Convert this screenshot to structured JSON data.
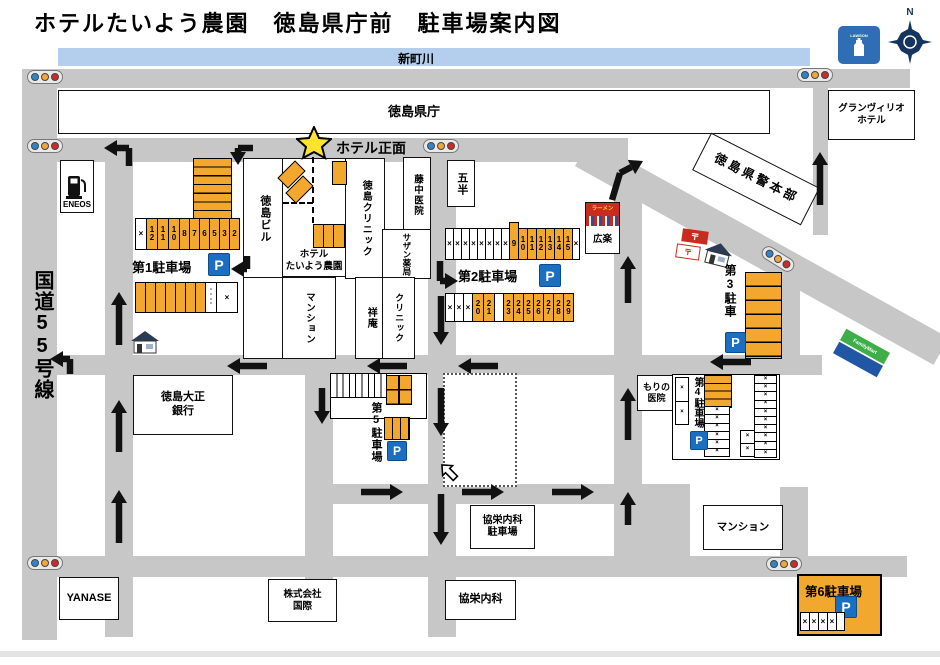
{
  "title": "ホテルたいよう農園　徳島県庁前　駐車場案内図",
  "labels": {
    "river": "新町川",
    "route55": "国道55号線",
    "hotel_front": "ホテル正面",
    "north": "N",
    "p_mark": "P",
    "x_mark": "×",
    "lawson": "LAWSON",
    "familymart": "FamilyMart",
    "post_mark": "〒"
  },
  "buildings": {
    "kencho": {
      "label": "徳島県庁"
    },
    "grandvrio": {
      "line1": "グランヴィリオ",
      "line2": "ホテル"
    },
    "eneos": {
      "label": "ENEOS"
    },
    "tokushima_bldg": {
      "label": "徳島ビル"
    },
    "hotel": {
      "line1": "ホテル",
      "line2": "たいよう農園"
    },
    "tokushima_clinic": {
      "label": "徳島クリニック"
    },
    "fujinaka": {
      "label": "藤中医院"
    },
    "southern_pharmacy": {
      "label": "サザン薬局"
    },
    "gohan": {
      "label": "五半"
    },
    "mansion_mid": {
      "label": "マンション"
    },
    "shoan": {
      "label": "祥庵"
    },
    "clinic": {
      "label": "クリニック"
    },
    "ramen": {
      "sign": "ラーメン",
      "label": "広楽"
    },
    "police": {
      "label": "徳島県警本部"
    },
    "taisho_bank": {
      "line1": "徳島大正",
      "line2": "銀行"
    },
    "mori_clinic": {
      "line1": "もりの",
      "line2": "医院"
    },
    "kyoei_parking": {
      "line1": "協栄内科",
      "line2": "駐車場"
    },
    "kyoei": {
      "label": "協栄内科"
    },
    "kokusai": {
      "line1": "株式会社",
      "line2": "国際"
    },
    "yanase": {
      "label": "YANASE"
    },
    "mansion_bottom": {
      "label": "マンション"
    }
  },
  "parkings": {
    "p1": {
      "name": "第1駐車場",
      "row_main": [
        {
          "t": "×",
          "c": "w",
          "w": 10
        },
        {
          "t": "12",
          "c": "y",
          "w": 10
        },
        {
          "t": "11",
          "c": "y",
          "w": 10
        },
        {
          "t": "10",
          "c": "y",
          "w": 10
        },
        {
          "t": "8",
          "c": "y",
          "w": 9
        },
        {
          "t": "7",
          "c": "y",
          "w": 9
        },
        {
          "t": "6",
          "c": "y",
          "w": 9
        },
        {
          "t": "5",
          "c": "y",
          "w": 9
        },
        {
          "t": "3",
          "c": "y",
          "w": 9
        },
        {
          "t": "2",
          "c": "y",
          "w": 9
        }
      ],
      "row_bottom": [
        {
          "t": "",
          "c": "y",
          "w": 9
        },
        {
          "t": "",
          "c": "y",
          "w": 9
        },
        {
          "t": "",
          "c": "y",
          "w": 9
        },
        {
          "t": "",
          "c": "y",
          "w": 9
        },
        {
          "t": "",
          "c": "y",
          "w": 9
        },
        {
          "t": "",
          "c": "y",
          "w": 9
        },
        {
          "t": "",
          "c": "y",
          "w": 9
        },
        {
          "t": "・・・・",
          "c": "w",
          "w": 10,
          "m": 1
        },
        {
          "t": "×",
          "c": "w",
          "w": 20
        }
      ]
    },
    "p2": {
      "name": "第2駐車場",
      "row_top": [
        {
          "t": "×",
          "c": "w",
          "w": 7
        },
        {
          "t": "×",
          "c": "w",
          "w": 7
        },
        {
          "t": "×",
          "c": "w",
          "w": 7
        },
        {
          "t": "×",
          "c": "w",
          "w": 7
        },
        {
          "t": "×",
          "c": "w",
          "w": 7
        },
        {
          "t": "×",
          "c": "w",
          "w": 7
        },
        {
          "t": "×",
          "c": "w",
          "w": 7
        },
        {
          "t": "×",
          "c": "w",
          "w": 7
        },
        {
          "t": "9",
          "c": "y",
          "w": 8,
          "tab": 1
        },
        {
          "t": "10",
          "c": "y",
          "w": 8
        },
        {
          "t": "11",
          "c": "y",
          "w": 8
        },
        {
          "t": "12",
          "c": "y",
          "w": 8
        },
        {
          "t": "13",
          "c": "y",
          "w": 8
        },
        {
          "t": "14",
          "c": "y",
          "w": 8
        },
        {
          "t": "15",
          "c": "y",
          "w": 8
        },
        {
          "t": "×",
          "c": "w",
          "w": 6
        }
      ],
      "row_bottom": [
        {
          "t": "×",
          "c": "w",
          "w": 8
        },
        {
          "t": "×",
          "c": "w",
          "w": 8
        },
        {
          "t": "×",
          "c": "w",
          "w": 8
        },
        {
          "t": "20",
          "c": "y",
          "w": 10
        },
        {
          "t": "21",
          "c": "y",
          "w": 10
        },
        {
          "t": "",
          "c": "w",
          "w": 8
        },
        {
          "t": "23",
          "c": "y",
          "w": 9
        },
        {
          "t": "24",
          "c": "y",
          "w": 9
        },
        {
          "t": "25",
          "c": "y",
          "w": 9
        },
        {
          "t": "26",
          "c": "y",
          "w": 9
        },
        {
          "t": "27",
          "c": "y",
          "w": 9
        },
        {
          "t": "28",
          "c": "y",
          "w": 9
        },
        {
          "t": "29",
          "c": "y",
          "w": 9
        }
      ]
    },
    "p3": {
      "name": "第3駐車"
    },
    "p4": {
      "name": "第4駐車場"
    },
    "p5": {
      "name": "第5駐車場"
    },
    "p6": {
      "name": "第6駐車場",
      "stalls": [
        {
          "t": "×",
          "c": "w",
          "w": 8
        },
        {
          "t": "×",
          "c": "w",
          "w": 8
        },
        {
          "t": "×",
          "c": "w",
          "w": 8
        },
        {
          "t": "×",
          "c": "w",
          "w": 8
        },
        {
          "t": "",
          "c": "w",
          "w": 7
        }
      ]
    }
  },
  "map": {
    "traffic_lights": [
      {
        "x": 27,
        "y": 70,
        "r": 0
      },
      {
        "x": 797,
        "y": 68,
        "r": 0
      },
      {
        "x": 27,
        "y": 139,
        "r": 0
      },
      {
        "x": 423,
        "y": 139,
        "r": 0
      },
      {
        "x": 760,
        "y": 252,
        "r": 32
      },
      {
        "x": 27,
        "y": 556,
        "r": 0
      },
      {
        "x": 766,
        "y": 557,
        "r": 0
      }
    ],
    "arrows": {
      "straight": [
        [
          119,
          345,
          119,
          292
        ],
        [
          119,
          452,
          119,
          400
        ],
        [
          119,
          543,
          119,
          490
        ],
        [
          628,
          303,
          628,
          256
        ],
        [
          628,
          440,
          628,
          388
        ],
        [
          628,
          525,
          628,
          492
        ],
        [
          820,
          205,
          820,
          152
        ],
        [
          441,
          296,
          441,
          345
        ],
        [
          441,
          388,
          441,
          436
        ],
        [
          441,
          494,
          441,
          545
        ],
        [
          322,
          388,
          322,
          424
        ],
        [
          267,
          366,
          227,
          366
        ],
        [
          407,
          366,
          367,
          366
        ],
        [
          498,
          366,
          458,
          366
        ],
        [
          751,
          362,
          710,
          362
        ],
        [
          361,
          492,
          403,
          492
        ],
        [
          462,
          492,
          504,
          492
        ],
        [
          552,
          492,
          594,
          492
        ]
      ],
      "bent": [
        [
          [
            129,
            166
          ],
          [
            129,
            148
          ],
          [
            104,
            148
          ]
        ],
        [
          [
            253,
            148
          ],
          [
            238,
            148
          ],
          [
            238,
            165
          ]
        ],
        [
          [
            247,
            256
          ],
          [
            247,
            269
          ],
          [
            231,
            269
          ]
        ],
        [
          [
            440,
            261
          ],
          [
            440,
            281
          ],
          [
            458,
            281
          ]
        ],
        [
          [
            70,
            374
          ],
          [
            70,
            359
          ],
          [
            50,
            359
          ]
        ],
        [
          [
            612,
            200
          ],
          [
            620,
            173
          ],
          [
            643,
            161
          ]
        ]
      ]
    }
  }
}
